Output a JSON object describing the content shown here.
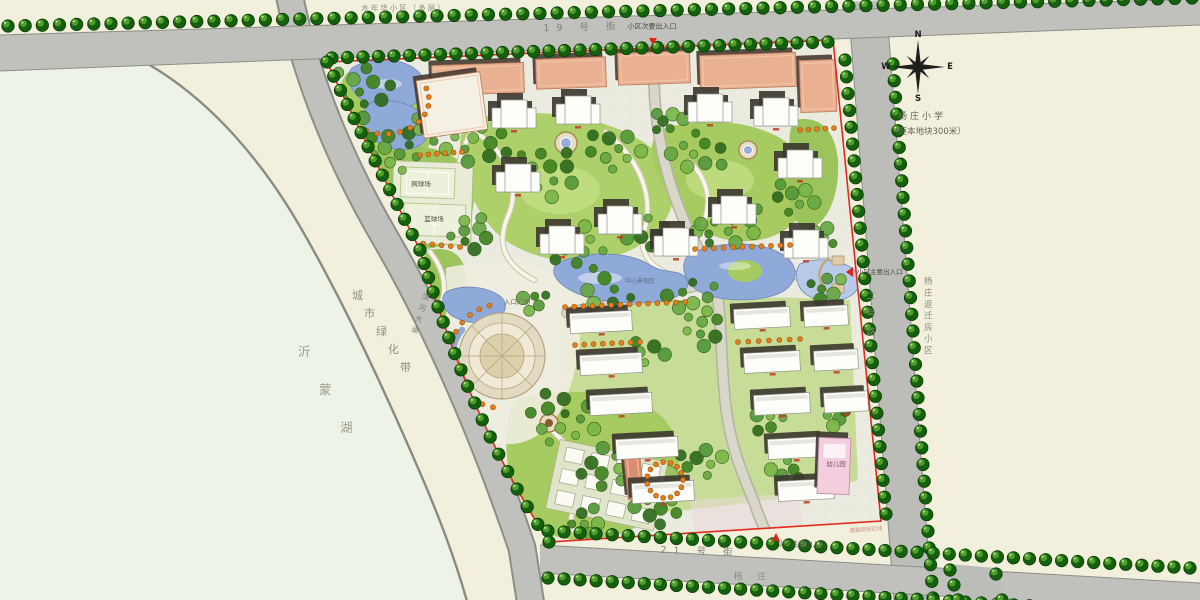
{
  "plan": {
    "labels": {
      "neighbor_top": "水年华小区（多层）",
      "street_top": "19 号 街",
      "entrance_top": "小区次要出入口",
      "school_name": "杨庄小学",
      "school_note": "（距本地块300米）",
      "entrance_east": "小区主要出入口",
      "road_east": "二号路",
      "neighbor_east": "杨庄返迁房小区",
      "green_belt": "城市绿化带",
      "lake": "沂蒙湖",
      "road_river": "滨河大道",
      "tennis_court": "网球场",
      "basketball_court": "篮球场",
      "entrance_plaza": "入口广场",
      "central_landscape": "中心景观区",
      "kindergarten": "幼儿园",
      "street_bottom": "21 号 街",
      "entrance_south": "小区主要出入口",
      "village_south": "杨 庄",
      "red_line_note": "道路规划红线"
    },
    "compass": {
      "n": "N",
      "s": "S",
      "e": "E",
      "w": "W"
    },
    "colors": {
      "boundary_red": "#e3281c",
      "water_blue": "#8fa9d8",
      "lawn_green": "#a6cb61",
      "road_gray": "#c0c1bd",
      "street_tree_green": "#15600f",
      "building_salmon": "#e9b092",
      "kindergarten_pink": "#f2cede",
      "background_cream": "#f2f0dc",
      "lake_pale": "#edf3e7"
    }
  }
}
